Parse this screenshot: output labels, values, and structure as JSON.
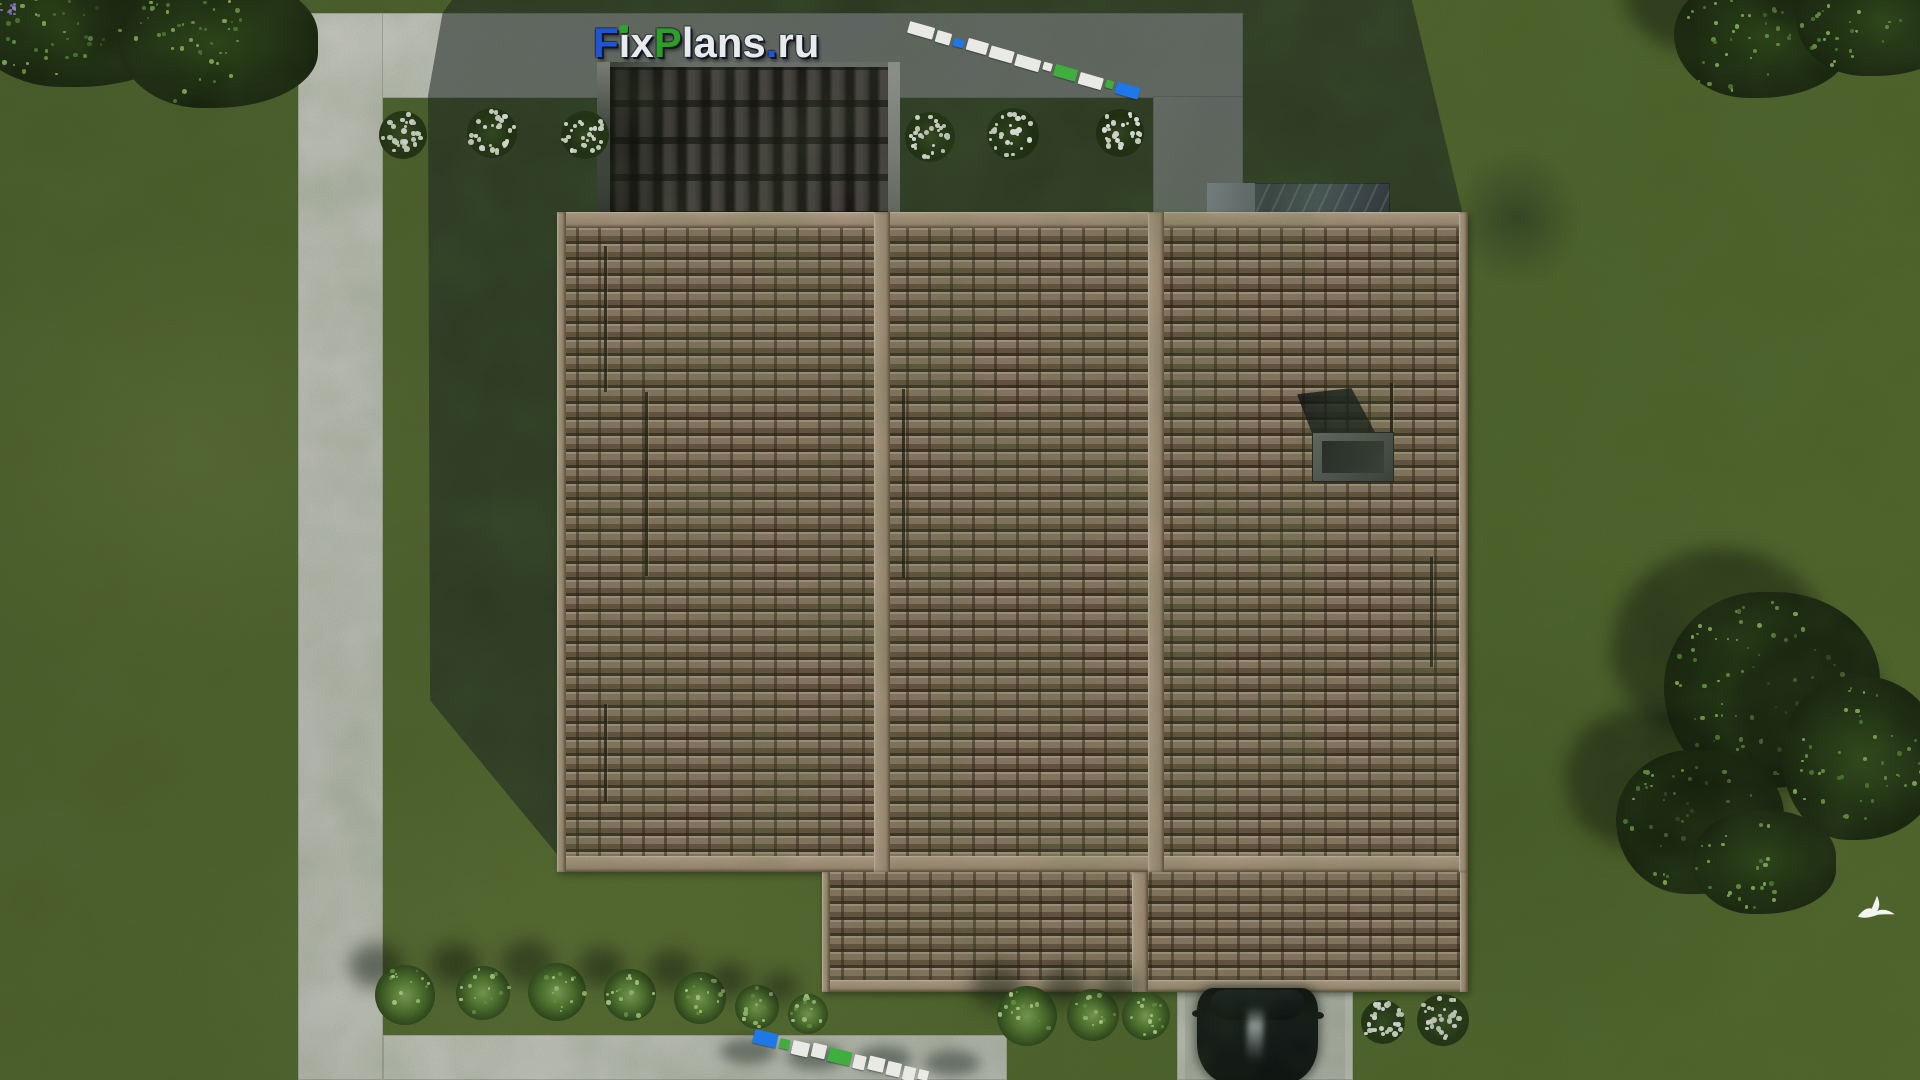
{
  "scene": {
    "type": "3d-architectural-render",
    "view": "top-down-site-plan",
    "branding": "FixPlans.ru"
  },
  "palette": {
    "grass": "#50642e",
    "grass_shadow": "#1f2d18",
    "pavement": "#d4d5d0",
    "roof_tile": "#8d7666",
    "roof_ridge": "#b49c8a",
    "pergola_tile": "#332d2f",
    "marble": "#3e4652",
    "car": "#07090d",
    "logo_blue": "#1f55d4",
    "logo_green": "#2d9e27",
    "logo_white": "#e9eaec",
    "wm_white": "#e9eae6",
    "wm_blue": "#1e78e8",
    "wm_green": "#3fae3f"
  },
  "logo": {
    "text": "FixPlans.ru",
    "letters": [
      {
        "ch": "F",
        "color": "#1f55d4"
      },
      {
        "ch": "i",
        "color": "#e9eaec",
        "dot_color": "#2da32b"
      },
      {
        "ch": "x",
        "color": "#e9eaec"
      },
      {
        "ch": "P",
        "color": "#2d9e27"
      },
      {
        "ch": "l",
        "color": "#e9eaec"
      },
      {
        "ch": "a",
        "color": "#e9eaec"
      },
      {
        "ch": "n",
        "color": "#e9eaec"
      },
      {
        "ch": "s",
        "color": "#e9eaec"
      },
      {
        "ch": ".",
        "color": "#1f55d4"
      },
      {
        "ch": "r",
        "color": "#e9eaec"
      },
      {
        "ch": "u",
        "color": "#e9eaec"
      }
    ]
  },
  "watermark_top": {
    "x": 910,
    "y": 22,
    "angle_deg": 16,
    "seg_h": 12,
    "gap": 3,
    "segments": [
      {
        "w": 26,
        "c": "wm_white"
      },
      {
        "w": 15,
        "c": "wm_white"
      },
      {
        "w": 11,
        "c": "wm_blue"
      },
      {
        "w": 21,
        "c": "wm_white"
      },
      {
        "w": 24,
        "c": "wm_white"
      },
      {
        "w": 25,
        "c": "wm_white"
      },
      {
        "w": 9,
        "c": "wm_white"
      },
      {
        "w": 23,
        "c": "wm_green"
      },
      {
        "w": 24,
        "c": "wm_white"
      },
      {
        "w": 8,
        "c": "wm_green"
      },
      {
        "w": 24,
        "c": "wm_blue"
      }
    ]
  },
  "watermark_bottom": {
    "x": 755,
    "y": 1030,
    "angle_deg": 13,
    "seg_h": 14,
    "gap": 3,
    "segments": [
      {
        "w": 24,
        "c": "wm_blue"
      },
      {
        "w": 10,
        "c": "wm_green"
      },
      {
        "w": 17,
        "c": "wm_white"
      },
      {
        "w": 14,
        "c": "wm_white"
      },
      {
        "w": 23,
        "c": "wm_green"
      },
      {
        "w": 12,
        "c": "wm_white"
      },
      {
        "w": 16,
        "c": "wm_white"
      },
      {
        "w": 14,
        "c": "wm_white"
      },
      {
        "w": 12,
        "c": "wm_white"
      },
      {
        "w": 10,
        "c": "wm_white"
      }
    ]
  },
  "roof": {
    "lines": [
      [
        604,
        246,
        146
      ],
      [
        645,
        392,
        184
      ],
      [
        604,
        704,
        98
      ],
      [
        902,
        389,
        189
      ],
      [
        1390,
        383,
        84
      ],
      [
        1430,
        557,
        110
      ]
    ],
    "chimney": {
      "x": 1313,
      "y": 433,
      "w": 80,
      "h": 48
    }
  },
  "vegetation": {
    "white_flower_bushes": [
      [
        403,
        135,
        24
      ],
      [
        492,
        133,
        25
      ],
      [
        585,
        135,
        24
      ],
      [
        930,
        137,
        25
      ],
      [
        1013,
        134,
        26
      ],
      [
        1120,
        133,
        24
      ],
      [
        1383,
        1022,
        22
      ],
      [
        1443,
        1020,
        26
      ]
    ],
    "green_bushes": [
      [
        405,
        995,
        30
      ],
      [
        483,
        993,
        27
      ],
      [
        557,
        992,
        29
      ],
      [
        630,
        995,
        26
      ],
      [
        700,
        998,
        26
      ],
      [
        757,
        1007,
        22
      ],
      [
        808,
        1014,
        20
      ],
      [
        1027,
        1016,
        30
      ],
      [
        1093,
        1015,
        26
      ],
      [
        1146,
        1016,
        24
      ]
    ],
    "trees": [
      {
        "cx": 80,
        "cy": 15,
        "rx": 115,
        "ry": 72
      },
      {
        "cx": 218,
        "cy": 42,
        "rx": 100,
        "ry": 66
      },
      {
        "cx": 1762,
        "cy": 36,
        "rx": 88,
        "ry": 62
      },
      {
        "cx": 1878,
        "cy": 20,
        "rx": 82,
        "ry": 56
      },
      {
        "cx": 1772,
        "cy": 690,
        "rx": 108,
        "ry": 98
      },
      {
        "cx": 1860,
        "cy": 758,
        "rx": 78,
        "ry": 82
      },
      {
        "cx": 1700,
        "cy": 822,
        "rx": 84,
        "ry": 72
      },
      {
        "cx": 1764,
        "cy": 862,
        "rx": 72,
        "ry": 52
      }
    ],
    "walkway_shadow_blobs": [
      [
        748,
        1052
      ],
      [
        815,
        1058
      ],
      [
        884,
        1060
      ],
      [
        952,
        1064
      ]
    ],
    "lavender": [
      381,
      995
    ]
  },
  "car": {
    "color": "#07090d"
  },
  "bird": {
    "x": 1853,
    "y": 893
  }
}
